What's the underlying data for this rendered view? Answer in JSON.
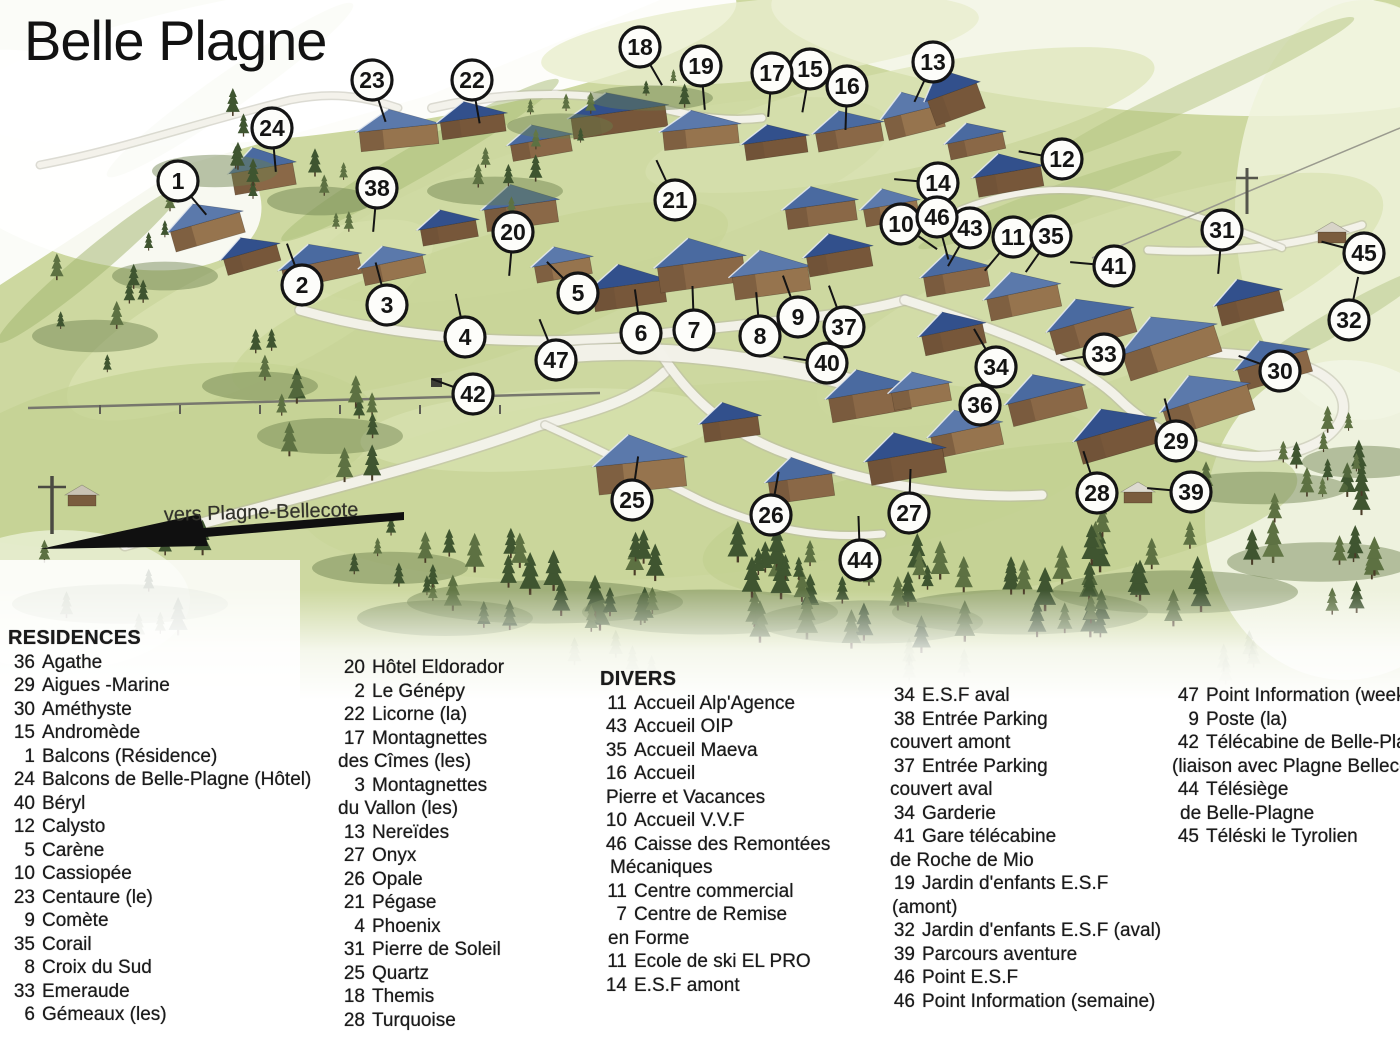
{
  "title": "Belle Plagne",
  "direction_label": "vers Plagne-Bellecote",
  "colors": {
    "ink": "#141414",
    "grass": "#cdd8a0",
    "grass_light": "#e2e8c3",
    "tree_dark": "#3f5530",
    "tree_mid": "#5d7142",
    "roof_blue": "#4a6aa0",
    "roof_blue_dark": "#32508c",
    "roof_blue_light": "#5b79ab",
    "wall_brown": "#8a6847",
    "wall_brown_dark": "#6d5036",
    "road": "#f4f3ec",
    "marker_fill": "#fdfdfa"
  },
  "map": {
    "markers": [
      [
        1,
        178,
        181,
        50
      ],
      [
        2,
        302,
        285,
        250
      ],
      [
        3,
        387,
        305,
        255
      ],
      [
        4,
        465,
        337,
        258
      ],
      [
        5,
        578,
        293,
        225
      ],
      [
        6,
        641,
        333,
        262
      ],
      [
        7,
        694,
        330,
        268
      ],
      [
        8,
        760,
        336,
        265
      ],
      [
        9,
        798,
        317,
        250
      ],
      [
        10,
        901,
        224,
        35
      ],
      [
        11,
        1013,
        237,
        130
      ],
      [
        12,
        1062,
        159,
        190
      ],
      [
        13,
        933,
        62,
        115
      ],
      [
        14,
        938,
        183,
        185
      ],
      [
        15,
        810,
        69,
        100
      ],
      [
        16,
        847,
        86,
        92
      ],
      [
        17,
        772,
        73,
        95
      ],
      [
        18,
        640,
        47,
        60
      ],
      [
        19,
        701,
        66,
        85
      ],
      [
        20,
        513,
        232,
        95
      ],
      [
        21,
        675,
        200,
        245
      ],
      [
        22,
        472,
        80,
        80
      ],
      [
        23,
        372,
        80,
        72
      ],
      [
        24,
        272,
        128,
        85
      ],
      [
        25,
        632,
        500,
        278
      ],
      [
        26,
        771,
        515,
        280
      ],
      [
        27,
        909,
        513,
        272
      ],
      [
        28,
        1097,
        493,
        252
      ],
      [
        29,
        1176,
        441,
        255
      ],
      [
        30,
        1280,
        371,
        200
      ],
      [
        31,
        1222,
        230,
        95
      ],
      [
        32,
        1349,
        320,
        282
      ],
      [
        33,
        1104,
        354,
        172
      ],
      [
        34,
        996,
        367,
        240
      ],
      [
        35,
        1051,
        236,
        125
      ],
      [
        36,
        980,
        405,
        275
      ],
      [
        37,
        844,
        327,
        250
      ],
      [
        38,
        377,
        188,
        95
      ],
      [
        39,
        1191,
        492,
        185
      ],
      [
        40,
        827,
        363,
        188
      ],
      [
        41,
        1114,
        266,
        185
      ],
      [
        42,
        473,
        394,
        200
      ],
      [
        43,
        970,
        228,
        120
      ],
      [
        44,
        860,
        560,
        268
      ],
      [
        45,
        1364,
        253,
        195
      ],
      [
        46,
        937,
        217,
        75
      ],
      [
        47,
        556,
        360,
        248
      ]
    ]
  },
  "legend": {
    "columns": [
      {
        "header": "RESIDENCES",
        "items": [
          [
            "36",
            "Agathe"
          ],
          [
            "29",
            "Aigues -Marine"
          ],
          [
            "30",
            "Améthyste"
          ],
          [
            "15",
            "Andromède"
          ],
          [
            "1",
            "Balcons (Résidence)"
          ],
          [
            "24",
            "Balcons de Belle-Plagne (Hôtel)"
          ],
          [
            "40",
            "Béryl"
          ],
          [
            "12",
            "Calysto"
          ],
          [
            "5",
            "Carène"
          ],
          [
            "10",
            "Cassiopée"
          ],
          [
            "23",
            "Centaure (le)"
          ],
          [
            "9",
            "Comète"
          ],
          [
            "35",
            "Corail"
          ],
          [
            "8",
            "Croix du Sud"
          ],
          [
            "33",
            "Emeraude"
          ],
          [
            "6",
            "Gémeaux (les)"
          ]
        ]
      },
      {
        "header": "",
        "items": [
          [
            "20",
            "Hôtel Eldorador"
          ],
          [
            "2",
            "Le Génépy"
          ],
          [
            "22",
            "Licorne (la)"
          ],
          [
            "17",
            "Montagnettes"
          ],
          [
            "",
            "des Cîmes (les)",
            0
          ],
          [
            "3",
            "Montagnettes"
          ],
          [
            "",
            "du Vallon (les)",
            0
          ],
          [
            "13",
            "Nereïdes"
          ],
          [
            "27",
            "Onyx"
          ],
          [
            "26",
            "Opale"
          ],
          [
            "21",
            "Pégase"
          ],
          [
            "4",
            "Phoenix"
          ],
          [
            "31",
            "Pierre de Soleil"
          ],
          [
            "25",
            "Quartz"
          ],
          [
            "18",
            "Themis"
          ],
          [
            "28",
            "Turquoise"
          ]
        ]
      },
      {
        "header": "DIVERS",
        "items": [
          [
            "11",
            "Accueil Alp'Agence"
          ],
          [
            "43",
            "Accueil OIP"
          ],
          [
            "35",
            "Accueil Maeva"
          ],
          [
            "16",
            "Accueil"
          ],
          [
            "",
            "Pierre et Vacances",
            6
          ],
          [
            "10",
            "Accueil V.V.F"
          ],
          [
            "46",
            "Caisse des Remontées"
          ],
          [
            "",
            "Mécaniques",
            10
          ],
          [
            "11",
            "Centre commercial"
          ],
          [
            "7",
            "Centre de Remise"
          ],
          [
            "",
            "en Forme",
            8
          ],
          [
            "11",
            "Ecole de ski EL PRO"
          ],
          [
            "14",
            "E.S.F amont"
          ]
        ]
      },
      {
        "header": "",
        "items": [
          [
            "34",
            "E.S.F aval"
          ],
          [
            "38",
            "Entrée Parking"
          ],
          [
            "",
            "couvert amont",
            2
          ],
          [
            "37",
            "Entrée Parking"
          ],
          [
            "",
            "couvert aval",
            2
          ],
          [
            "34",
            "Garderie"
          ],
          [
            "41",
            "Gare télécabine"
          ],
          [
            "",
            "de Roche de Mio",
            2
          ],
          [
            "19",
            "Jardin d'enfants E.S.F"
          ],
          [
            "",
            "(amont)",
            4
          ],
          [
            "32",
            "Jardin d'enfants E.S.F (aval)"
          ],
          [
            "39",
            "Parcours aventure"
          ],
          [
            "46",
            "Point E.S.F"
          ],
          [
            "46",
            "Point Information (semaine)"
          ]
        ]
      },
      {
        "header": "",
        "items": [
          [
            "47",
            "Point Information (week-end)"
          ],
          [
            "9",
            "Poste (la)"
          ],
          [
            "42",
            "Télécabine de Belle-Plagne"
          ],
          [
            "",
            "(liaison avec Plagne Bellecôte)",
            0
          ],
          [
            "44",
            "Télésiège"
          ],
          [
            "",
            "de Belle-Plagne",
            8
          ],
          [
            "45",
            "Téléski le Tyrolien"
          ]
        ]
      }
    ]
  }
}
